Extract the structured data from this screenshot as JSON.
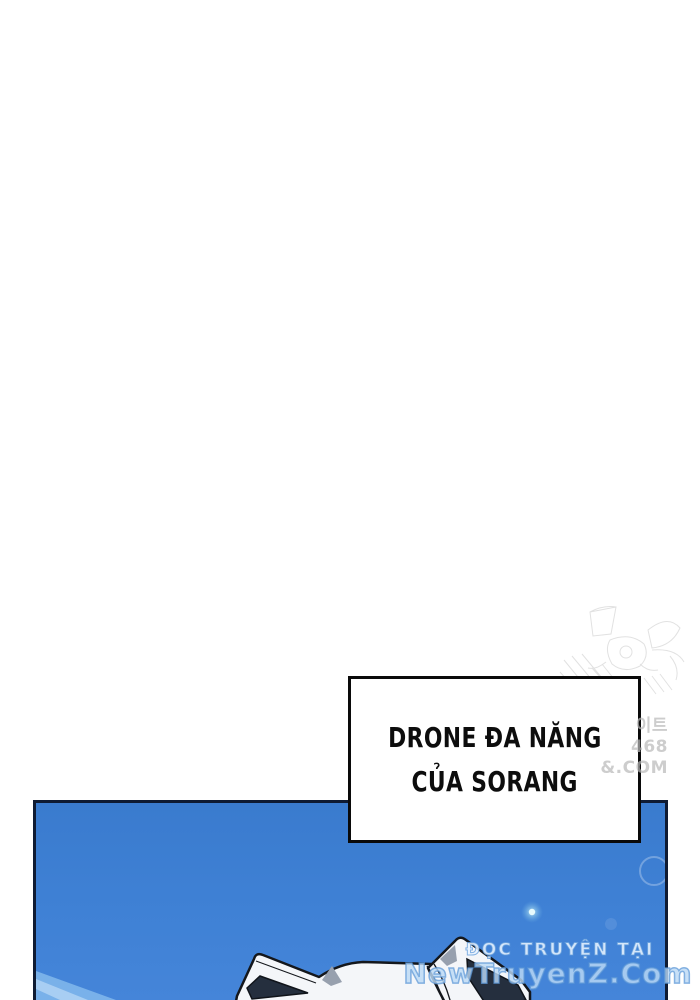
{
  "caption": {
    "line1": "DRONE ĐA NĂNG",
    "line2": "CỦA SORANG"
  },
  "side_watermark": {
    "line1": "이트",
    "line2": "468",
    "line3": "&.COM"
  },
  "bottom_watermark": {
    "line1": "ĐỌC TRUYỆN TẠI",
    "line2": "NewTruyenZ.Com"
  },
  "colors": {
    "page_background": "#ffffff",
    "panel_blue": "#3f81d5",
    "panel_border": "#0f1b33",
    "caption_border": "#0a0a0a",
    "caption_text": "#0d0d0d",
    "ear_white": "#f4f6f9",
    "ear_inner_dark": "#252f3e",
    "ear_accent_gray": "#97a0ae",
    "outline_black": "#14171c",
    "light_streak": "#82b8ec",
    "glow_core": "#d9f3f7",
    "watermark_fill": "#bcd9f5",
    "watermark_outline": "#5d9bd6",
    "sketch_gray": "#c5c5c5"
  }
}
